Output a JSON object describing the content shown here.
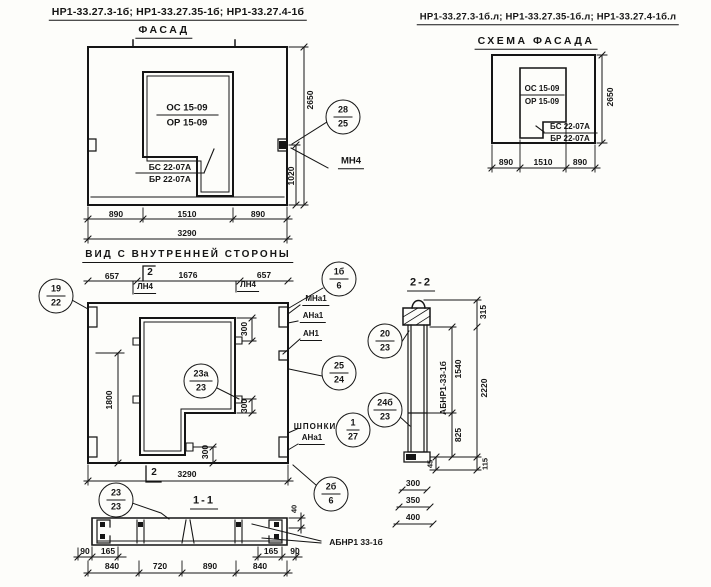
{
  "header": {
    "marks_left": "НР1-33.27.3-1б; НР1-33.27.35-1б; НР1-33.27.4-1б",
    "marks_right": "НР1-33.27.3-1б.л; НР1-33.27.35-1б.л; НР1-33.27.4-1б.л"
  },
  "facade": {
    "title": "ФАСАД",
    "window_label_top": "ОС 15-09",
    "window_label_bottom": "ОР 15-09",
    "sill_label_top": "БС 22-07А",
    "sill_label_bottom": "БР 22-07А",
    "bottom_dims": [
      "890",
      "1510",
      "890"
    ],
    "total_width": "3290",
    "height_total": "2650",
    "height_part": "1020",
    "callout_28": {
      "top": "28",
      "bottom": "25"
    },
    "mn4_label": "МН4"
  },
  "scheme": {
    "title": "СХЕМА ФАСАДА",
    "window_label_top": "ОС 15-09",
    "window_label_bottom": "ОР 15-09",
    "sill_label_top": "БС 22-07А",
    "sill_label_bottom": "БР 22-07А",
    "bottom_dims": [
      "890",
      "1510",
      "890"
    ],
    "height_total": "2650"
  },
  "inner": {
    "title": "ВИД С ВНУТРЕННЕЙ СТОРОНЫ",
    "top_dims": [
      "657",
      "1676",
      "657"
    ],
    "ln4_left": "ЛН4",
    "ln4_right": "ЛН4",
    "section_mark_top": "2",
    "section_mark_bottom": "2",
    "dim_1800": "1800",
    "dim_300_a": "300",
    "dim_300_b": "300",
    "dim_300_c": "300",
    "total_width": "3290",
    "label_mna1": "МНа1",
    "label_ana1": "АНа1",
    "label_an1": "АН1",
    "label_shponki": "ШПОНКИ",
    "label_ana1b": "АНа1",
    "callout_19": {
      "top": "19",
      "bottom": "22"
    },
    "callout_1b": {
      "top": "1б",
      "bottom": "6"
    },
    "callout_25": {
      "top": "25",
      "bottom": "24"
    },
    "callout_23a": {
      "top": "23а",
      "bottom": "23"
    },
    "callout_20": {
      "top": "20",
      "bottom": "23"
    },
    "callout_24b": {
      "top": "24б",
      "bottom": "23"
    },
    "callout_1_27": {
      "top": "1",
      "bottom": "27"
    },
    "callout_2b": {
      "top": "2б",
      "bottom": "6"
    }
  },
  "section2": {
    "title": "2-2",
    "panel_label": "АБНР1-33-1б",
    "dim_315": "315",
    "dim_1540": "1540",
    "dim_2220": "2220",
    "dim_825": "825",
    "dim_45": "45",
    "dim_115": "115",
    "dim_300": "300",
    "dim_350": "350",
    "dim_400": "400"
  },
  "section1": {
    "title": "1-1",
    "panel_label": "АБНР1 33-1б",
    "dim_90_left": "90",
    "dim_165_left": "165",
    "dim_165_right": "165",
    "dim_90_right": "90",
    "dim_40": "40",
    "bottom_dims": [
      "840",
      "720",
      "890",
      "840"
    ],
    "callout_23": {
      "top": "23",
      "bottom": "23"
    }
  }
}
